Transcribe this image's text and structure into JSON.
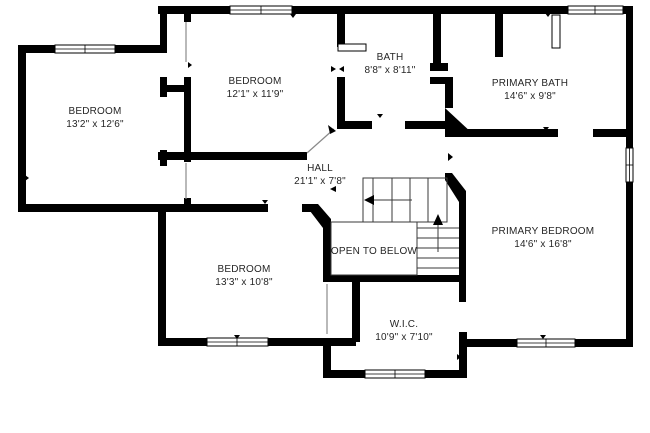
{
  "floorplan": {
    "background": "#ffffff",
    "wall_color": "#000000",
    "text_color": "#262626",
    "rooms": [
      {
        "name": "BEDROOM",
        "dims": "13'2\" x 12'6\""
      },
      {
        "name": "BEDROOM",
        "dims": "12'1\" x 11'9\""
      },
      {
        "name": "BATH",
        "dims": "8'8\" x 8'11\""
      },
      {
        "name": "PRIMARY BATH",
        "dims": "14'6\" x 9'8\""
      },
      {
        "name": "HALL",
        "dims": "21'1\" x 7'8\""
      },
      {
        "name": "PRIMARY BEDROOM",
        "dims": "14'6\" x 16'8\""
      },
      {
        "name": "BEDROOM",
        "dims": "13'3\" x 10'8\""
      },
      {
        "name": "W.I.C.",
        "dims": "10'9\" x 7'10\""
      }
    ],
    "annotations": [
      {
        "label": "OPEN TO BELOW"
      }
    ]
  }
}
